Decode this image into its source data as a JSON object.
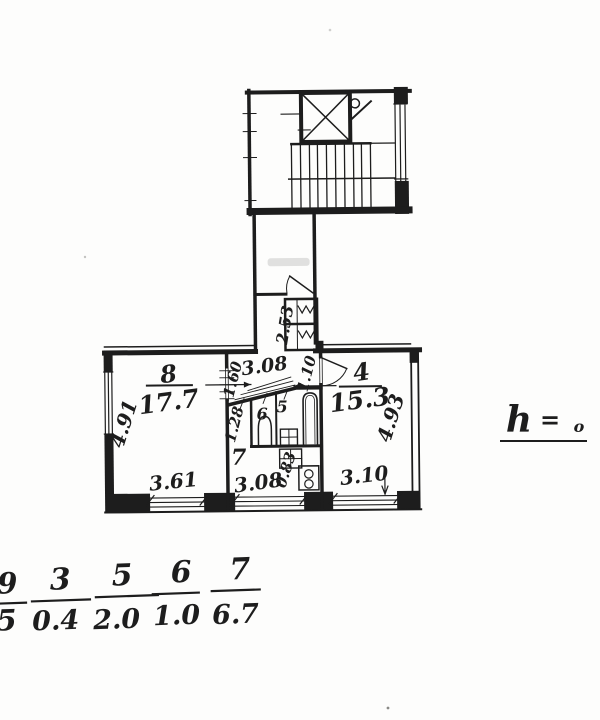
{
  "document": {
    "kind": "scanned apartment floor plan",
    "ink_color": "#1d1d1d",
    "paper_color": "#fdfdfc"
  },
  "rooms": {
    "r8": {
      "number": "8",
      "area": "17.7"
    },
    "r4": {
      "number": "4",
      "area": "15.3"
    },
    "r7": {
      "number": "7"
    },
    "r5": {
      "number": "5"
    },
    "r6": {
      "number": "6"
    }
  },
  "dimensions": {
    "left_side": "4.91",
    "right_side": "4.93",
    "room8_bottom": "3.61",
    "room7_bottom": "3.08",
    "room4_bottom": "3.10",
    "hall_width": "3.08",
    "closet_depth": "2.53",
    "hall_door": "1.60",
    "room4_door": "1.10",
    "wc_width": "1.28",
    "stove_width": "0.83"
  },
  "height_note": {
    "symbol": "h",
    "equals": "=",
    "value": "o"
  },
  "legend_fractions": [
    {
      "numerator": "9",
      "denominator": "5"
    },
    {
      "numerator": "3",
      "denominator": "0.4"
    },
    {
      "numerator": "5",
      "denominator": "2.0"
    },
    {
      "numerator": "6",
      "denominator": "1.0"
    },
    {
      "numerator": "7",
      "denominator": "6.7"
    }
  ]
}
